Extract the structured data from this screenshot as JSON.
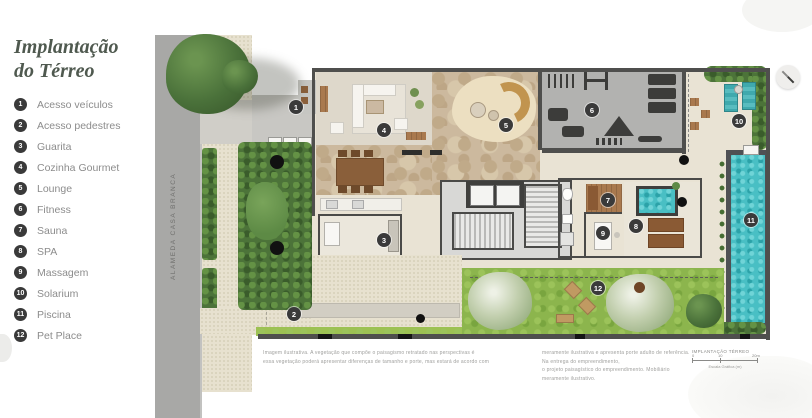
{
  "sidebar": {
    "title": [
      "Implantação",
      "do Térreo"
    ],
    "items": [
      {
        "number": "1",
        "label": "Acesso veículos"
      },
      {
        "number": "2",
        "label": "Acesso pedestres"
      },
      {
        "number": "3",
        "label": "Guarita"
      },
      {
        "number": "4",
        "label": "Cozinha Gourmet"
      },
      {
        "number": "5",
        "label": "Lounge"
      },
      {
        "number": "6",
        "label": "Fitness"
      },
      {
        "number": "7",
        "label": "Sauna"
      },
      {
        "number": "8",
        "label": "SPA"
      },
      {
        "number": "9",
        "label": "Massagem"
      },
      {
        "number": "10",
        "label": "Solarium"
      },
      {
        "number": "11",
        "label": "Piscina"
      },
      {
        "number": "12",
        "label": "Pet Place"
      }
    ]
  },
  "plan": {
    "street_name": "ALAMEDA CASA BRANCA",
    "markers": [
      {
        "number": "1",
        "label": "Acesso veículos"
      },
      {
        "number": "2",
        "label": "Acesso pedestres"
      },
      {
        "number": "3",
        "label": "Guarita"
      },
      {
        "number": "4",
        "label": "Cozinha Gourmet"
      },
      {
        "number": "5",
        "label": "Lounge"
      },
      {
        "number": "6",
        "label": "Fitness"
      },
      {
        "number": "7",
        "label": "Sauna"
      },
      {
        "number": "8",
        "label": "SPA"
      },
      {
        "number": "9",
        "label": "Massagem"
      },
      {
        "number": "10",
        "label": "Solarium"
      },
      {
        "number": "11",
        "label": "Piscina"
      },
      {
        "number": "12",
        "label": "Pet Place"
      }
    ],
    "scale": {
      "title": "IMPLANTAÇÃO TÉRREO",
      "ticks": [
        "0",
        "10",
        "20m"
      ],
      "caption": "Escala Gráfica (m)"
    }
  },
  "footer": {
    "left1": "Imagem ilustrativa. A vegetação que compõe o paisagismo retratado nas perspectivas é",
    "left2": "essa vegetação poderá apresentar diferenças de tamanho e porte, mas estará de acordo com",
    "right1": "meramente ilustrativa e apresenta porte adulto de referência. Na entrega do empreendimento,",
    "right2": "o projeto paisagístico do empreendimento. Mobiliário meramente ilustrativo."
  },
  "colors": {
    "badge": "#3a3a3a",
    "title": "#4f594f",
    "legend_text": "#8c8c8c",
    "street": "#a8a8a6",
    "pool": "#49bfc4",
    "lawn": "#8cb54d",
    "wall": "#4f4f4d"
  }
}
